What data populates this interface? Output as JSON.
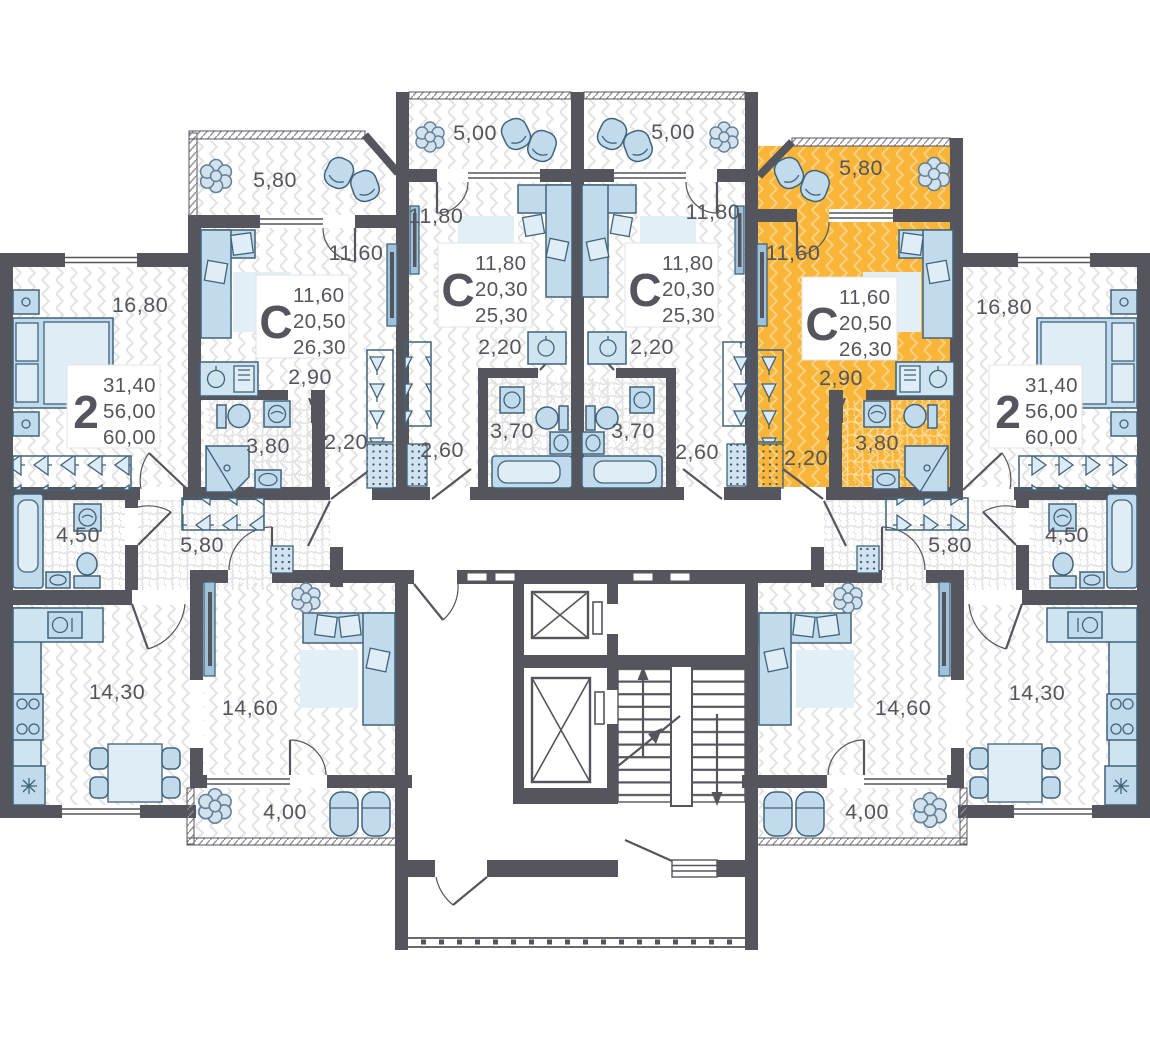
{
  "plan": {
    "colors": {
      "highlight": "#F8B537",
      "wall": "#54555D",
      "furniture": "#C2DBEC",
      "text": "#54555D"
    },
    "apartments": [
      {
        "id": "A",
        "type": "2",
        "stats": [
          "31,40",
          "56,00",
          "60,00"
        ],
        "highlighted": false,
        "rooms": {
          "bedroom": "16,80",
          "bathroom": "4,50",
          "hall": "5,80",
          "kitchen": "14,30",
          "living": "14,60",
          "balcony": "4,00"
        }
      },
      {
        "id": "B",
        "type": "С",
        "stats": [
          "11,60",
          "20,50",
          "26,30"
        ],
        "highlighted": false,
        "rooms": {
          "balcony": "5,80",
          "room": "11,60",
          "kitchen": "2,90",
          "bathroom": "3,80",
          "corridor": "2,20"
        }
      },
      {
        "id": "C",
        "type": "С",
        "stats": [
          "11,80",
          "20,30",
          "25,30"
        ],
        "highlighted": false,
        "rooms": {
          "balcony": "5,00",
          "room": "11,80",
          "kitchen": "2,20",
          "bathroom": "3,70",
          "corridor": "2,60"
        }
      },
      {
        "id": "D",
        "type": "С",
        "stats": [
          "11,80",
          "20,30",
          "25,30"
        ],
        "highlighted": false,
        "rooms": {
          "balcony": "5,00",
          "room": "11,80",
          "kitchen": "2,20",
          "bathroom": "3,70",
          "corridor": "2,60"
        }
      },
      {
        "id": "E",
        "type": "С",
        "stats": [
          "11,60",
          "20,50",
          "26,30"
        ],
        "highlighted": true,
        "rooms": {
          "balcony": "5,80",
          "room": "11,60",
          "kitchen": "2,90",
          "bathroom": "3,80",
          "corridor": "2,20"
        }
      },
      {
        "id": "F",
        "type": "2",
        "stats": [
          "31,40",
          "56,00",
          "60,00"
        ],
        "highlighted": false,
        "rooms": {
          "bedroom": "16,80",
          "bathroom": "4,50",
          "hall": "5,80",
          "kitchen": "14,30",
          "living": "14,60",
          "balcony": "4,00"
        }
      }
    ]
  }
}
